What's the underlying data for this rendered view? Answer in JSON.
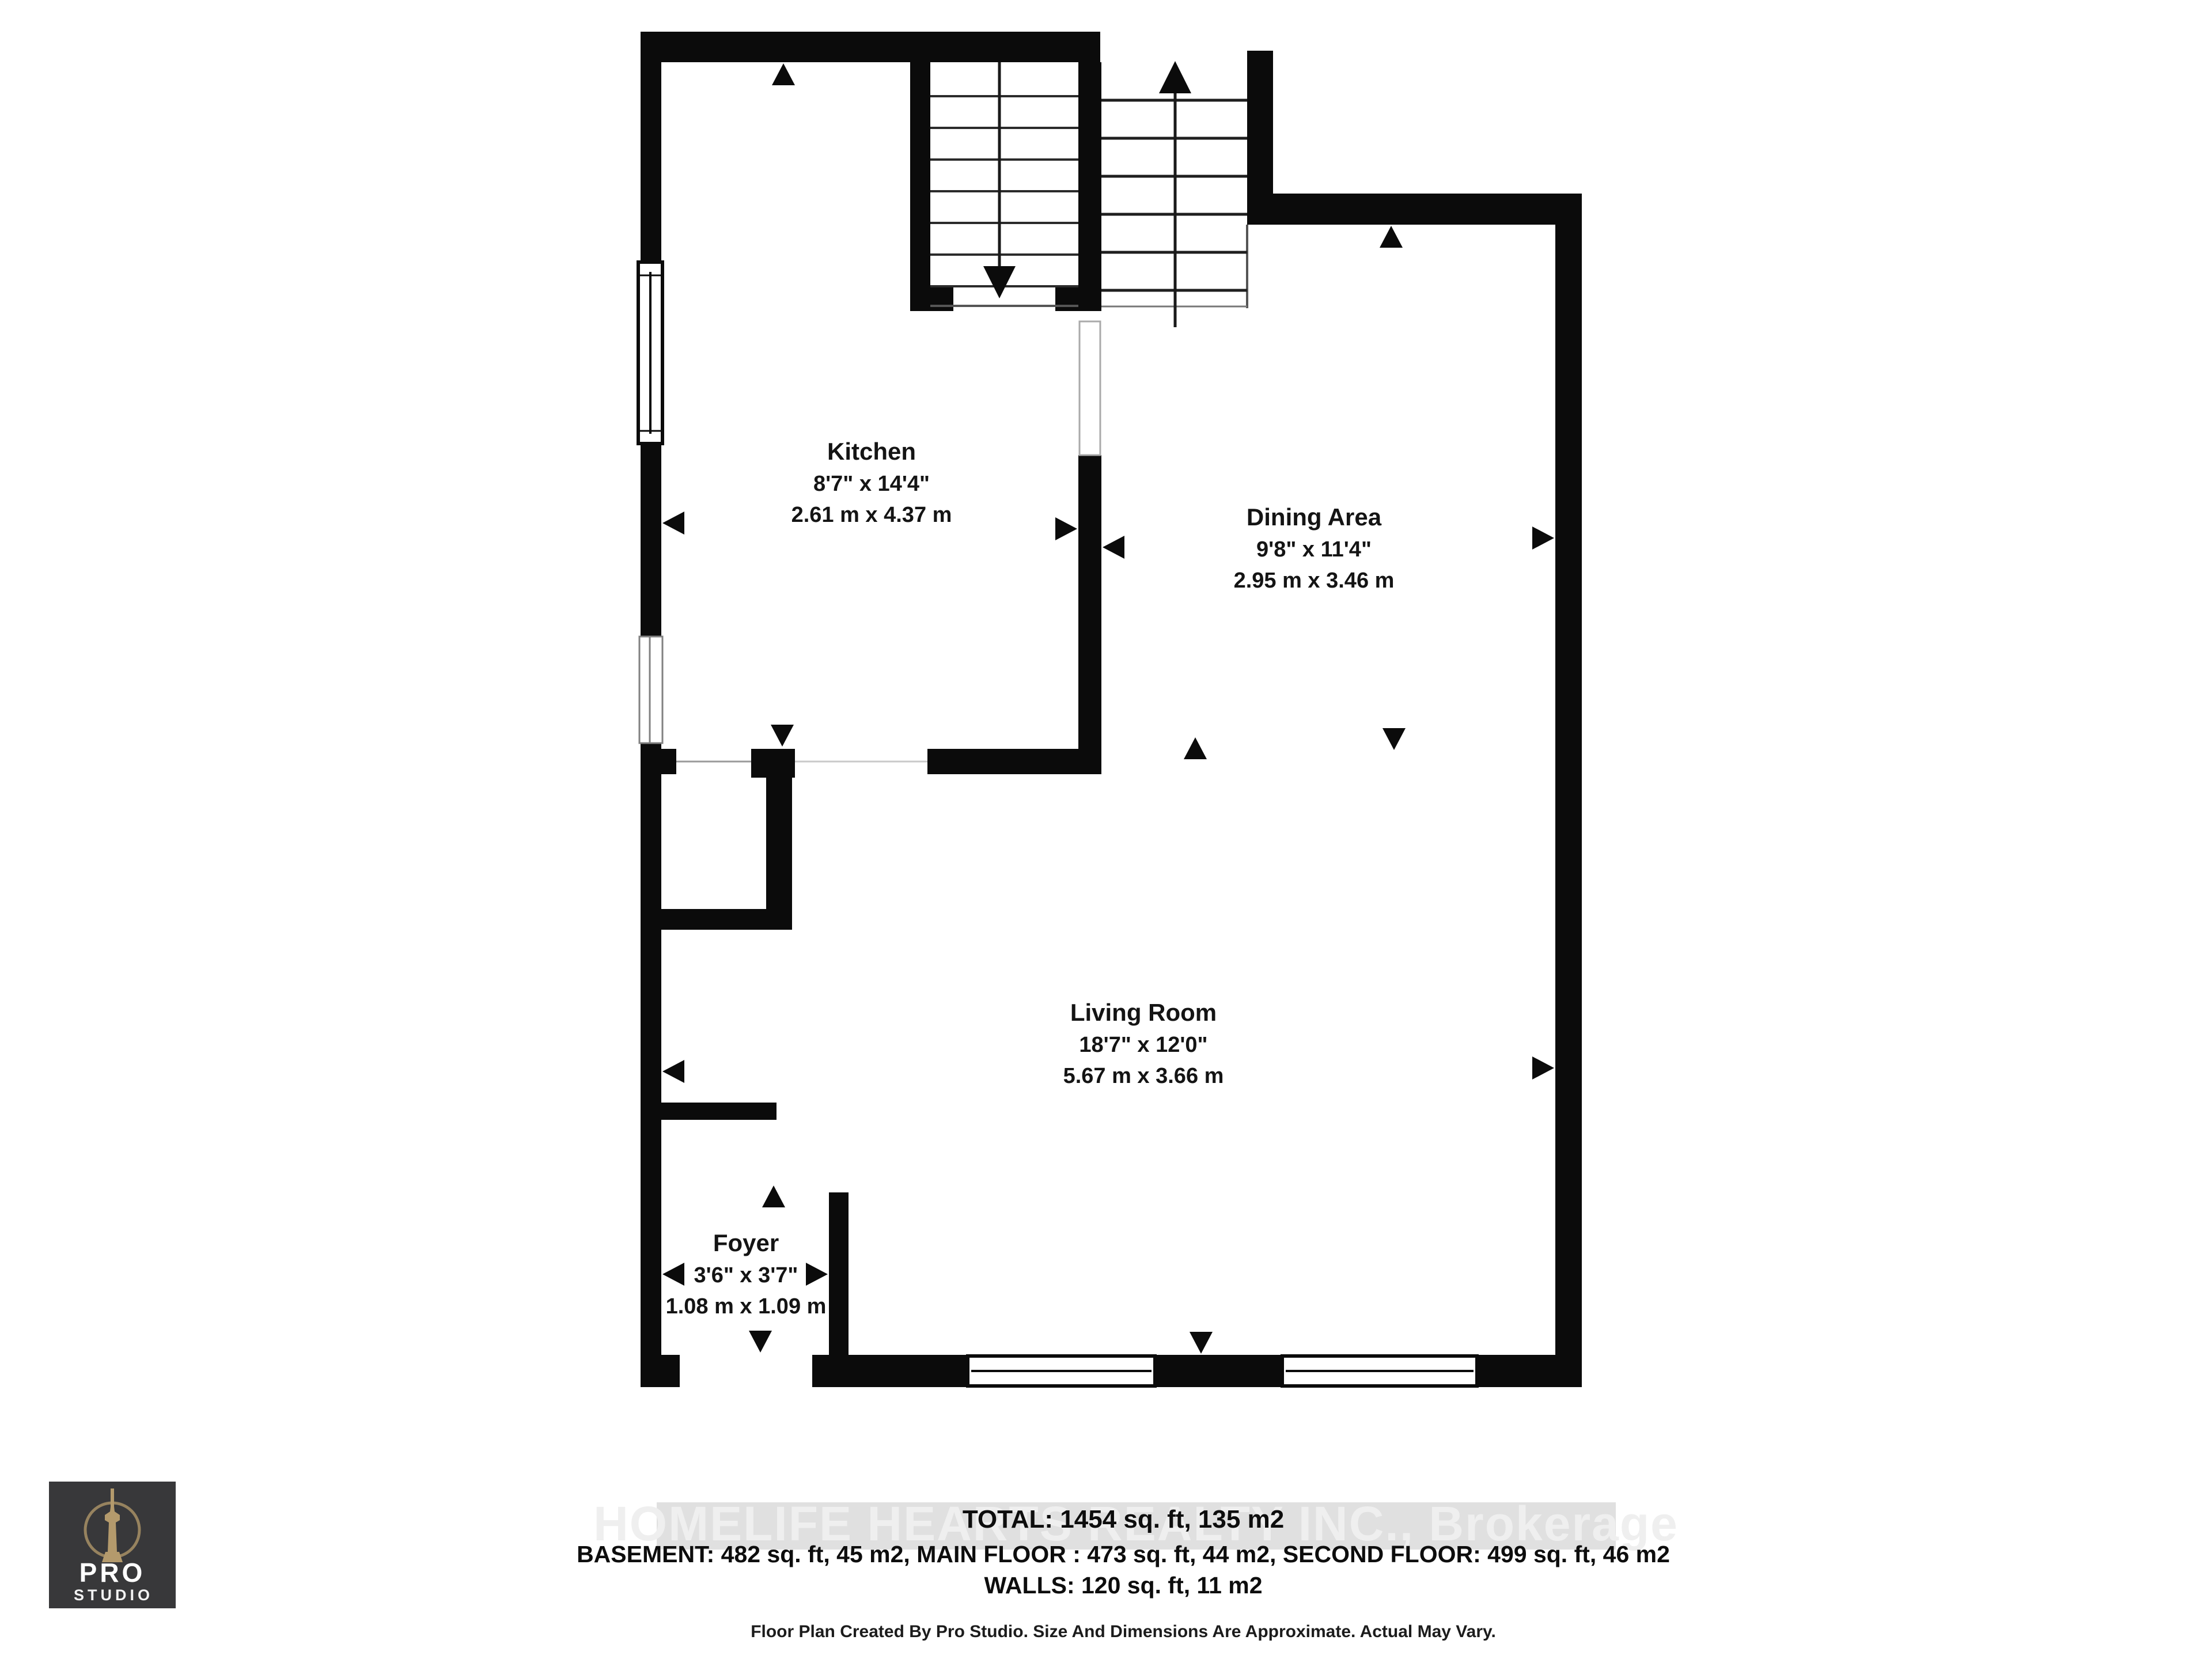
{
  "page": {
    "background": "#ffffff",
    "wall_color": "#0b0b0b"
  },
  "plan": {
    "rooms": [
      {
        "name": "Kitchen",
        "imperial": "8'7\" x 14'4\"",
        "metric": "2.61 m x 4.37 m"
      },
      {
        "name": "Dining Area",
        "imperial": "9'8\" x 11'4\"",
        "metric": "2.95 m x 3.46 m"
      },
      {
        "name": "Living Room",
        "imperial": "18'7\" x 12'0\"",
        "metric": "5.67 m x 3.66 m"
      },
      {
        "name": "Foyer",
        "imperial": "3'6\" x 3'7\"",
        "metric": "1.08 m x 1.09 m"
      }
    ],
    "stairs": {
      "left_direction": "down",
      "right_direction": "up"
    }
  },
  "watermark": {
    "text": "HOMELIFE HEARTS REALTY INC., Brokerage",
    "band_color": "#c6c6c6"
  },
  "footer": {
    "total": "TOTAL: 1454 sq. ft, 135 m2",
    "floors": "BASEMENT: 482 sq. ft, 45 m2, MAIN FLOOR : 473 sq. ft, 44 m2, SECOND FLOOR: 499 sq. ft, 46 m2",
    "walls": "WALLS: 120 sq. ft, 11 m2",
    "disclaimer": "Floor Plan Created By Pro Studio. Size And Dimensions Are Approximate. Actual May Vary."
  },
  "logo": {
    "line1": "PRO",
    "line2": "STUDIO"
  }
}
